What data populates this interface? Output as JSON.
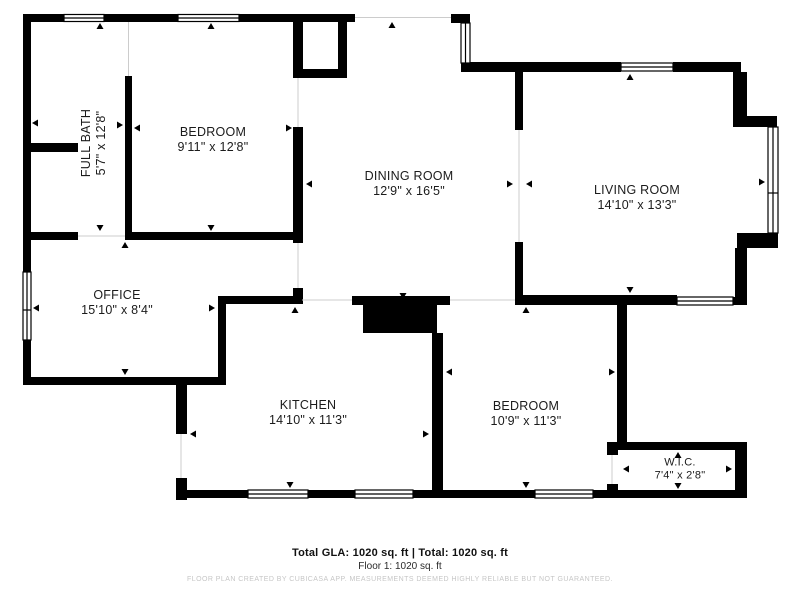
{
  "plan": {
    "rooms": [
      {
        "name": "FULL BATH",
        "dims": "5'7\" x 12'8\""
      },
      {
        "name": "BEDROOM",
        "dims": "9'11\" x 12'8\""
      },
      {
        "name": "DINING ROOM",
        "dims": "12'9\" x 16'5\""
      },
      {
        "name": "LIVING ROOM",
        "dims": "14'10\" x 13'3\""
      },
      {
        "name": "OFFICE",
        "dims": "15'10\" x 8'4\""
      },
      {
        "name": "KITCHEN",
        "dims": "14'10\" x 11'3\""
      },
      {
        "name": "BEDROOM",
        "dims": "10'9\" x 11'3\""
      },
      {
        "name": "W.I.C.",
        "dims": "7'4\" x 2'8\""
      }
    ],
    "footer": {
      "totals": "Total GLA: 1020 sq. ft | Total: 1020 sq. ft",
      "floor": "Floor 1: 1020 sq. ft",
      "watermark": "FLOOR PLAN CREATED BY CUBICASA APP. MEASUREMENTS DEEMED HIGHLY RELIABLE BUT NOT GUARANTEED."
    },
    "colors": {
      "wall": "#000000",
      "background": "#ffffff",
      "opening_line": "#cccccc",
      "watermark": "#c6c6c6",
      "text": "#1b1b1b"
    }
  }
}
